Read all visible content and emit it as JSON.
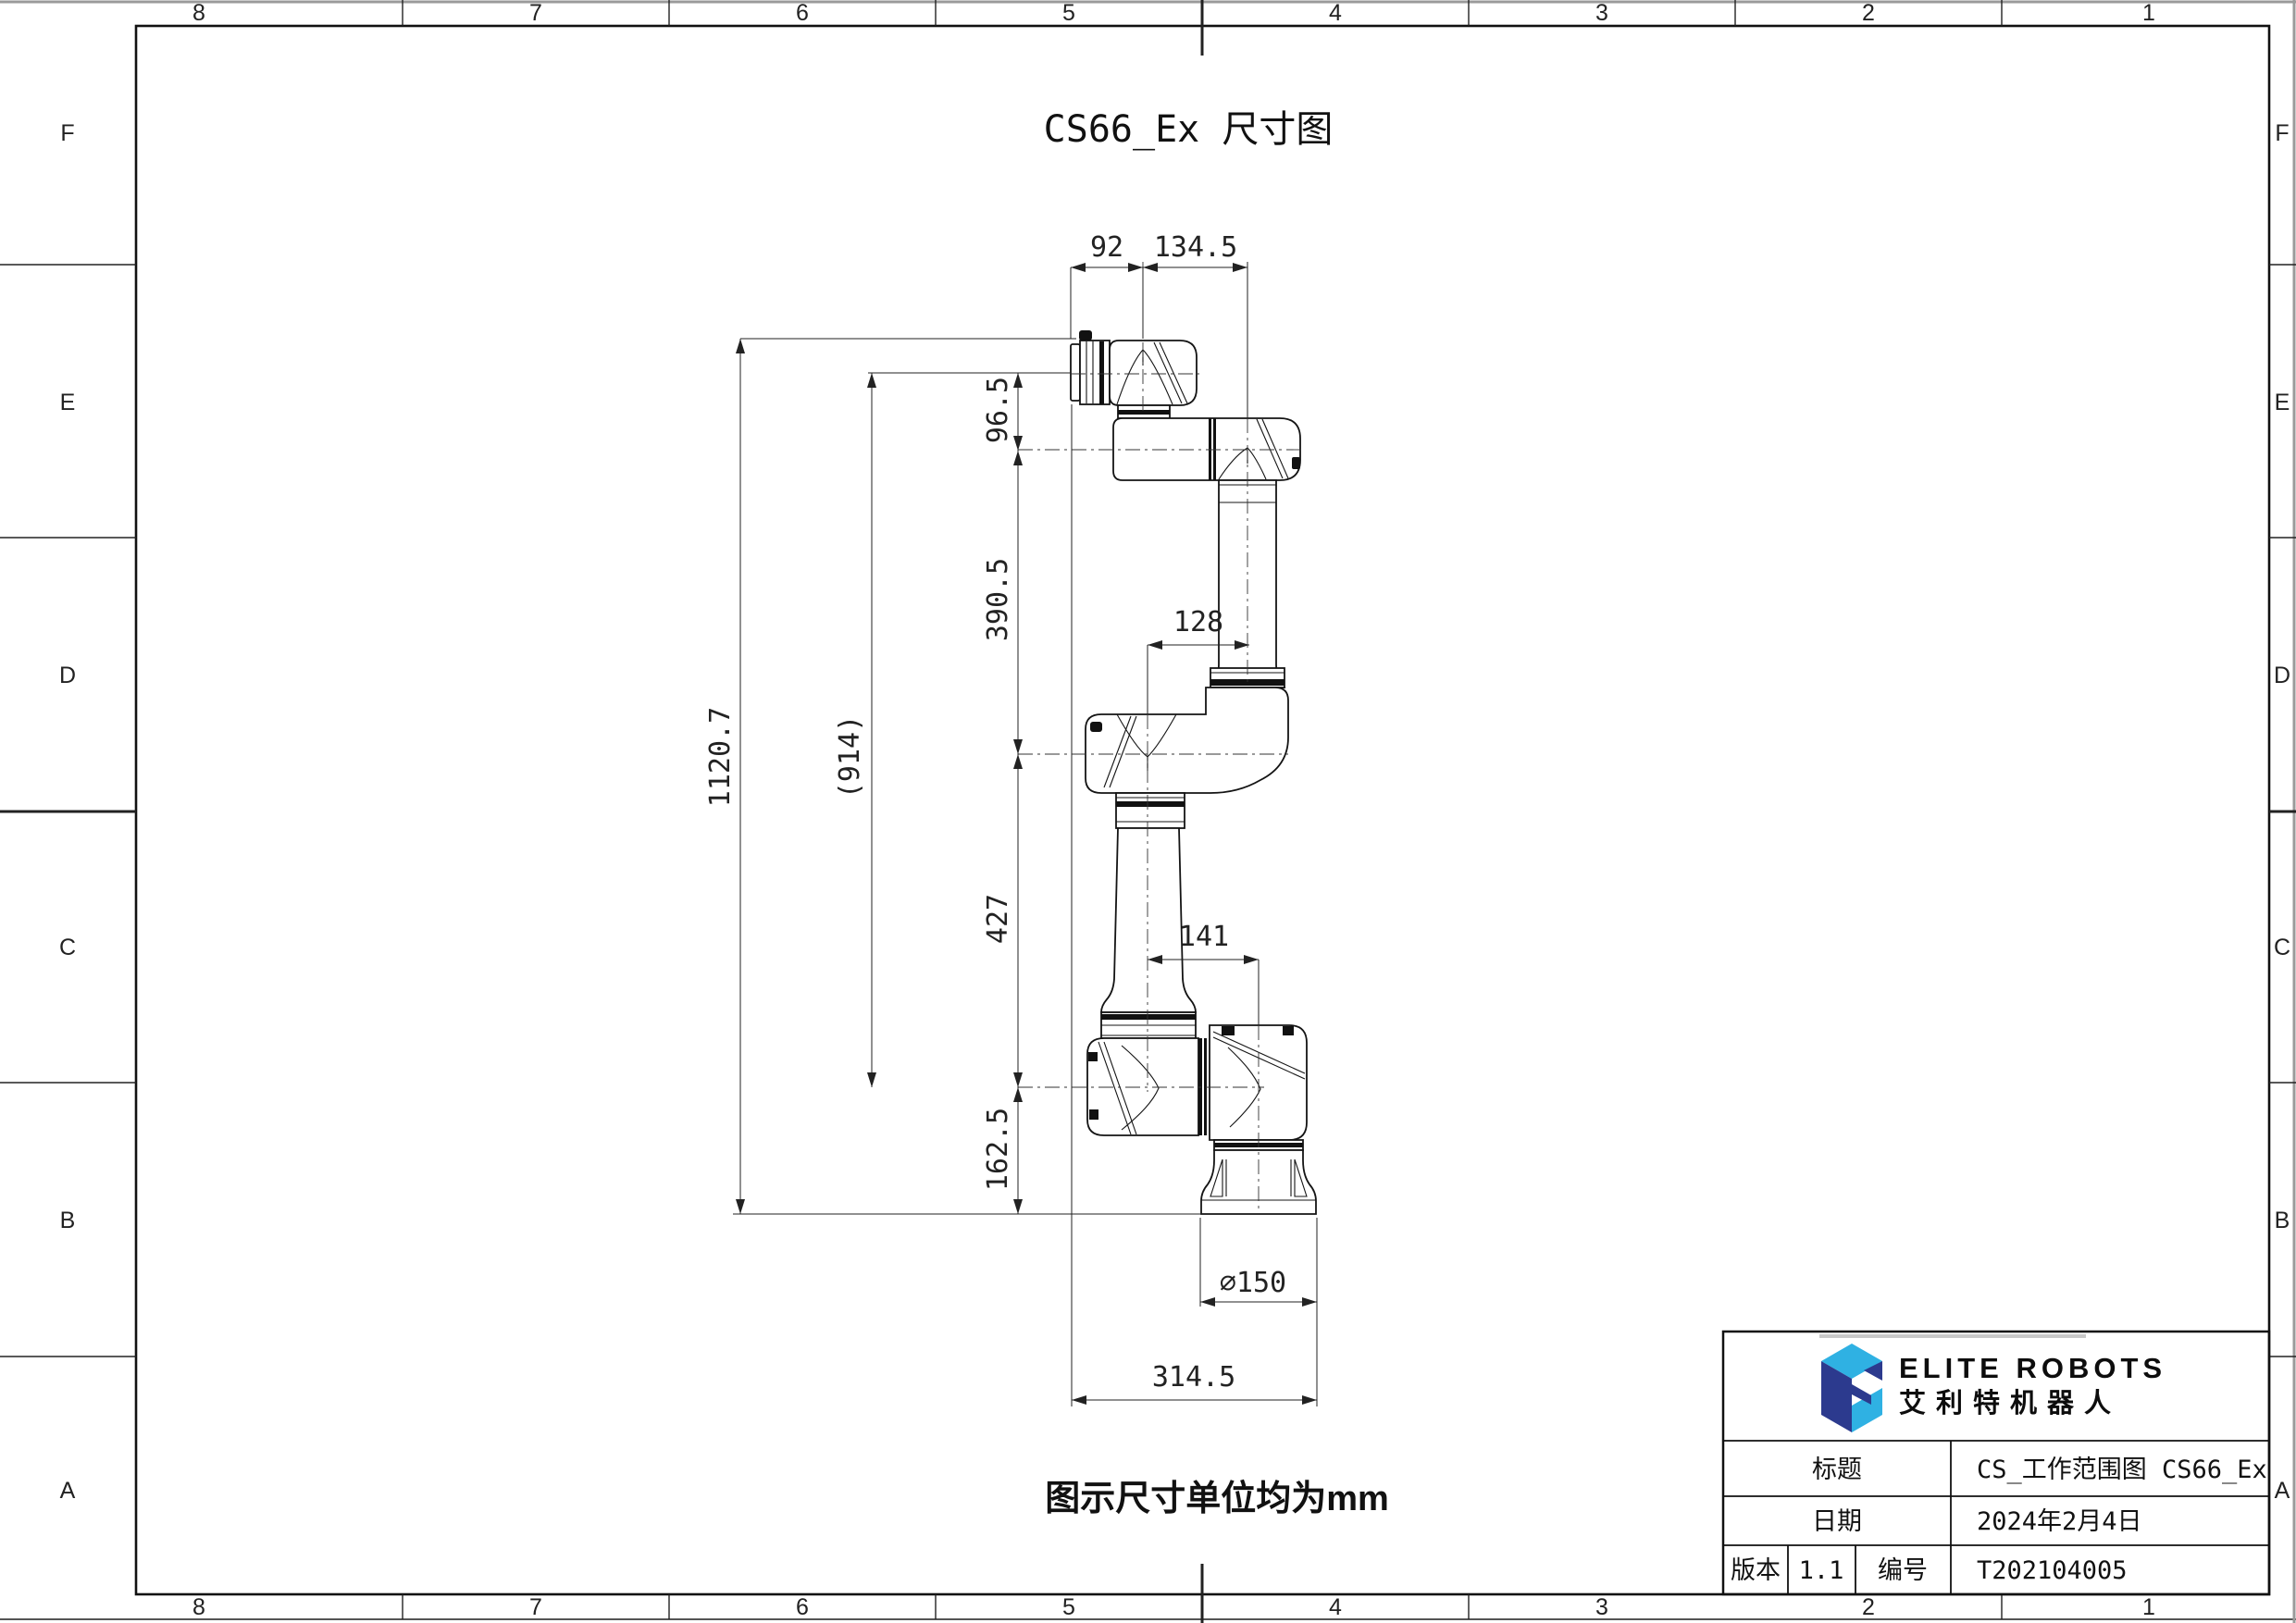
{
  "sheet": {
    "title": "CS66_Ex 尺寸图",
    "note": "图示尺寸单位均为mm",
    "zone_columns": [
      "8",
      "7",
      "6",
      "5",
      "4",
      "3",
      "2",
      "1"
    ],
    "zone_rows": [
      "F",
      "E",
      "D",
      "C",
      "B",
      "A"
    ]
  },
  "dimensions": {
    "d92": "92",
    "d134_5": "134.5",
    "d96_5": "96.5",
    "d390_5": "390.5",
    "d1120_7": "1120.7",
    "d914": "(914)",
    "d128": "128",
    "d427": "427",
    "d141": "141",
    "d162_5": "162.5",
    "d150": "∅150",
    "d314_5": "314.5"
  },
  "title_block": {
    "brand_en": "ELITE ROBOTS",
    "brand_cn": "艾利特机器人",
    "title_label": "标题",
    "title_value": "CS_工作范围图 CS66_Ex",
    "date_label": "日期",
    "date_value": "2024年2月4日",
    "version_label": "版本",
    "version_value": "1.1",
    "number_label": "编号",
    "number_value": "T202104005",
    "logo_colors": {
      "light_blue": "#2fb1e3",
      "navy": "#2c3a8e"
    }
  }
}
